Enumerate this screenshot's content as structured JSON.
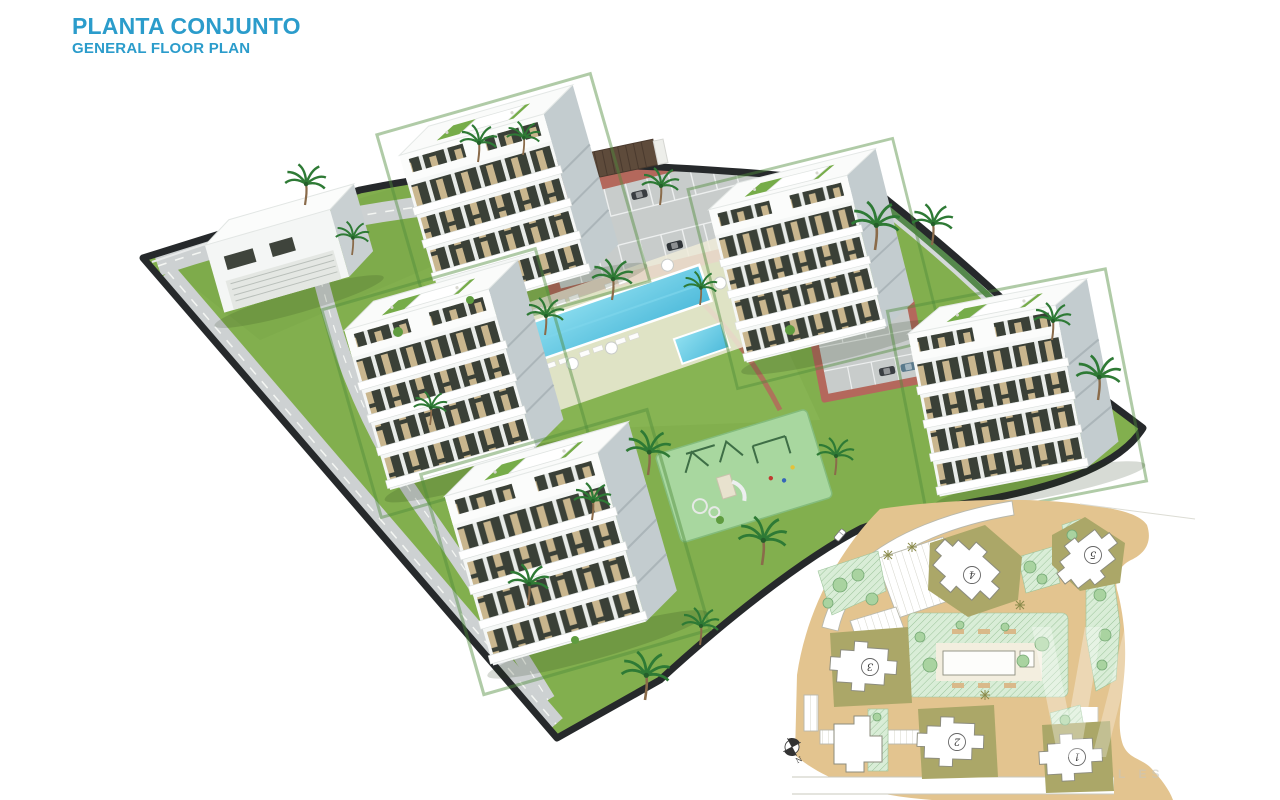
{
  "header": {
    "title": "PLANTA CONJUNTO",
    "subtitle": "GENERAL FLOOR PLAN",
    "title_color": "#2B9CCB"
  },
  "main_render": {
    "kind": "3d-aerial-site-render",
    "palette": {
      "lawn": "#82AF4E",
      "road": "#CDD1D2",
      "boundary_dark": "#26292B",
      "brick_paving": "#B4685C",
      "pool_water": "#58C4E0",
      "building_white": "#F5F7F6",
      "building_shade": "#C3CCCF",
      "window_dark": "#3A4037",
      "window_tan": "#C9B68E",
      "palm_green": "#2E7A35",
      "playground_green": "#A8D79F"
    }
  },
  "site_plan_inset": {
    "compass": {
      "label": "N"
    },
    "watermark_text": "L ES",
    "buildings": [
      {
        "label": "1"
      },
      {
        "label": "2"
      },
      {
        "label": "3"
      },
      {
        "label": "4"
      },
      {
        "label": "5"
      }
    ],
    "palette": {
      "land": "#E3C48F",
      "building_pad": "#ABA768",
      "hatch_green": "#D9EDD7",
      "tree_green": "#A9D3A0",
      "outline": "#8C8C7E"
    }
  }
}
